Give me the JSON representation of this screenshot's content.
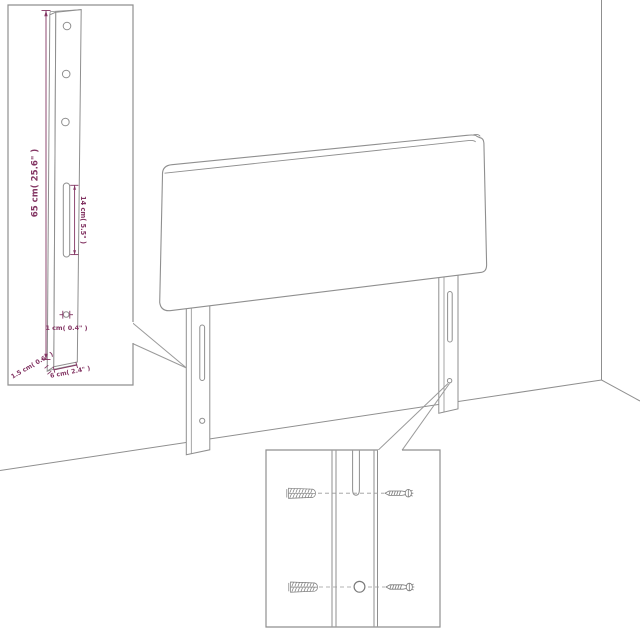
{
  "diagram": {
    "subject": "headboard-assembly-dimension-diagram",
    "colors": {
      "background": "#ffffff",
      "line_art": "#8f8f8f",
      "hardware": "#7a7a7a",
      "dimension_accent": "#833563"
    },
    "dims": {
      "post_height": "65 cm( 25.6\" )",
      "slot_length": "14 cm( 5.5\" )",
      "hole_diameter": "1 cm( 0.4\" )",
      "post_depth": "1.5 cm( 0.6\" )",
      "post_width": "6 cm( 2.4\" )"
    },
    "insets": {
      "leg_detail": {
        "features": [
          "three-mounting-holes",
          "hanging-slot",
          "bottom-hole"
        ]
      },
      "hardware_detail": {
        "features": [
          "wall-plug",
          "screw",
          "hanging-slot",
          "round-hole"
        ]
      }
    }
  }
}
